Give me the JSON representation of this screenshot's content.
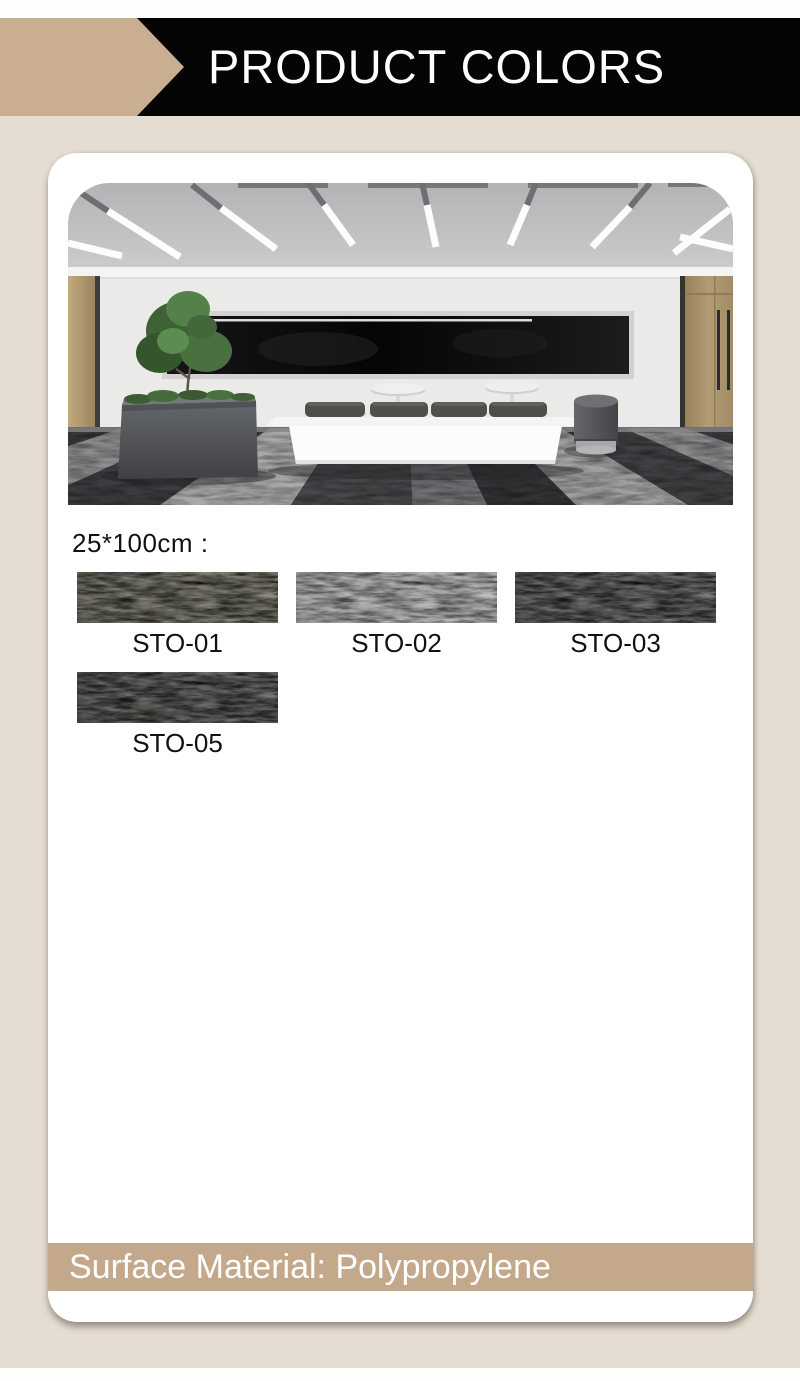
{
  "banner": {
    "title": "PRODUCT COLORS"
  },
  "section": {
    "size_label": "25*100cm :"
  },
  "swatches": [
    {
      "code": "STO-01",
      "color": "#5f5d50"
    },
    {
      "code": "STO-02",
      "color": "#9b9b99"
    },
    {
      "code": "STO-03",
      "color": "#4c4c4f"
    },
    {
      "code": "STO-05",
      "color": "#484744"
    }
  ],
  "footer": {
    "text": "Surface Material: Polypropylene"
  },
  "theme": {
    "accent_tan": "#c9ae92",
    "footer_tan": "#c3a88c",
    "page_background": "#e6ddd2",
    "banner_black": "#050505",
    "text_color": "#111111",
    "title_color": "#ffffff"
  }
}
